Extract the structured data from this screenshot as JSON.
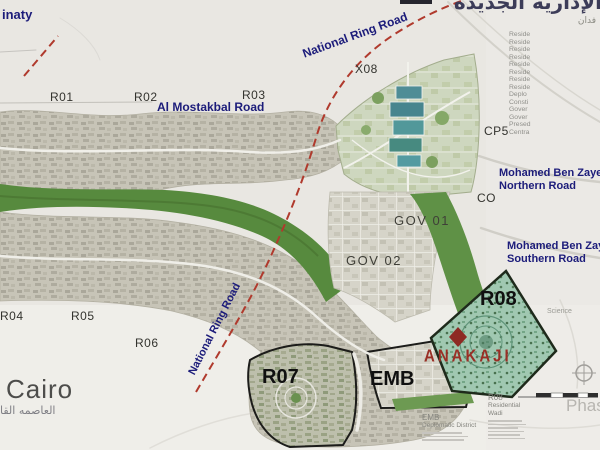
{
  "title_ar": "الإدارية الجديدة",
  "area_note_ar": "فدان",
  "context": {
    "madinaty": "inaty",
    "cairo": "Cairo",
    "cairo_ar": "العاصمه القا",
    "science": "Science",
    "phase": "Phase"
  },
  "districts": {
    "r01": "R01",
    "r02": "R02",
    "r03": "R03",
    "r04": "R04",
    "r05": "R05",
    "r06": "R06",
    "r07": "R07",
    "r08": "R08",
    "x08": "X08",
    "cp5": "CP5",
    "co": "CO",
    "gov01": "GOV 01",
    "gov02": "GOV 02",
    "emb": "EMB"
  },
  "roads": {
    "national_ring": "National Ring Road",
    "mostakbal": "Al Mostakbal Road",
    "mbz_north_l1": "Mohamed Ben Zayed",
    "mbz_north_l2": "Northern Road",
    "mbz_south_l1": "Mohamed Ben Zayed",
    "mbz_south_l2": "Southern Road"
  },
  "legend": {
    "items": [
      "Reside",
      "Reside",
      "Reside",
      "Reside",
      "Reside",
      "Reside",
      "Reside",
      "Reside",
      "Deplo",
      "Consti",
      "Gover",
      "Gover",
      "Presed",
      "Centra"
    ]
  },
  "logo": {
    "name": "ANAKAJI",
    "mark": "diamond-icon"
  },
  "footnotes": {
    "emb_title": "EMB",
    "emb_sub": "Deplomatic District",
    "r08_title": "R08",
    "r08_sub": "Residential Wadi"
  },
  "icons": {
    "compass": "crosshair-circle",
    "scale": "segmented-scale-bar"
  },
  "colors": {
    "road_label_navy": "#1c1c7a",
    "ring_road_red": "#b03a2d",
    "logo_red": "#9a2f26",
    "r08_fill": "#a0c8b1",
    "district_outline": "#1c1c1a",
    "green_river": "#578a3e"
  }
}
